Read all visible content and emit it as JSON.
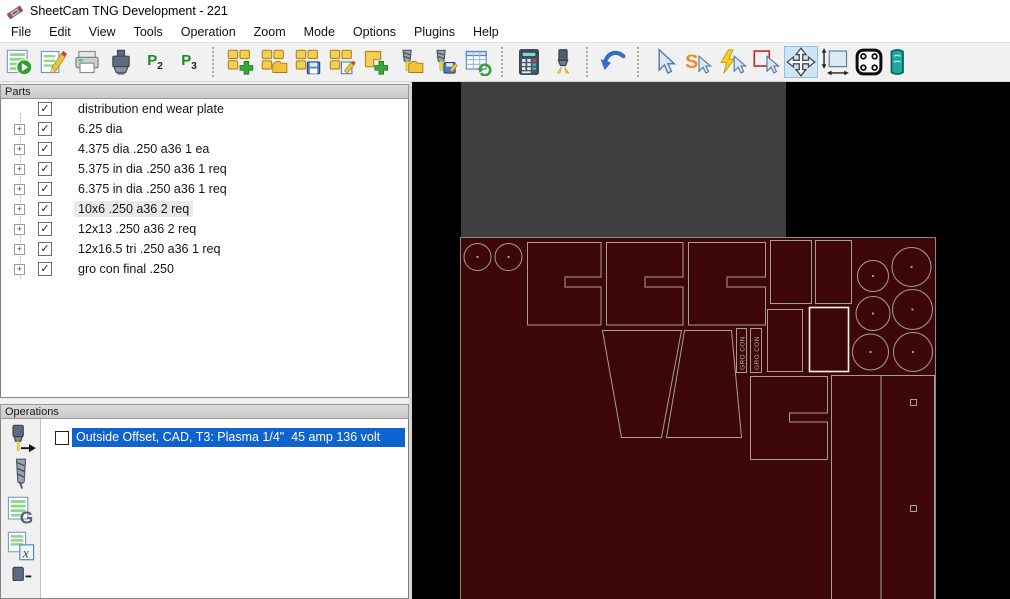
{
  "window": {
    "title": "SheetCam TNG Development - 221"
  },
  "menu": {
    "items": [
      "File",
      "Edit",
      "View",
      "Tools",
      "Operation",
      "Zoom",
      "Mode",
      "Options",
      "Plugins",
      "Help"
    ]
  },
  "toolbar": {
    "p2": {
      "letter": "P",
      "sub": "2"
    },
    "p3": {
      "letter": "P",
      "sub": "3"
    },
    "icon_names": [
      "run-postprocess",
      "edit-postprocess",
      "print",
      "machine-connection",
      "post2",
      "post3",
      "new-job",
      "open-job",
      "save-job",
      "edit-job",
      "add-part",
      "open-toolset",
      "save-toolset",
      "refresh-table",
      "calculator",
      "simulate-torch",
      "undo",
      "select-cursor",
      "select-contour",
      "select-rapid",
      "select-rectangle",
      "move-parts",
      "measure",
      "edit-plate",
      "clipped-right"
    ]
  },
  "icons": {
    "checkmark": "✓",
    "expander_plus": "+"
  },
  "parts_panel": {
    "title": "Parts",
    "items": [
      {
        "label": "distribution end wear plate",
        "expandable": false,
        "checked": true,
        "highlighted": false
      },
      {
        "label": "6.25 dia",
        "expandable": true,
        "checked": true,
        "highlighted": false
      },
      {
        "label": "4.375 dia .250 a36 1 ea",
        "expandable": true,
        "checked": true,
        "highlighted": false
      },
      {
        "label": "5.375 in dia .250 a36 1 req",
        "expandable": true,
        "checked": true,
        "highlighted": false
      },
      {
        "label": "6.375 in dia .250 a36 1 req",
        "expandable": true,
        "checked": true,
        "highlighted": false
      },
      {
        "label": "10x6 .250 a36 2 req",
        "expandable": true,
        "checked": true,
        "highlighted": true
      },
      {
        "label": "12x13 .250 a36 2 req",
        "expandable": true,
        "checked": true,
        "highlighted": false
      },
      {
        "label": "12x16.5 tri .250 a36 1 req",
        "expandable": true,
        "checked": true,
        "highlighted": false
      },
      {
        "label": "gro con final .250",
        "expandable": true,
        "checked": true,
        "highlighted": false
      }
    ]
  },
  "operations_panel": {
    "title": "Operations",
    "items": [
      {
        "label": "Outside Offset, CAD, T3: Plasma 1/4\"  45 amp 136 volt",
        "checked": false,
        "selected": true
      }
    ]
  },
  "canvas": {
    "part_labels": {
      "gro_con_1": "GRO CON",
      "gro_con_2": "GRO CON"
    }
  },
  "colors": {
    "selection_blue": "#0f63cf",
    "sheet_maroon": "#3d0707",
    "table_gray": "#3f3f3f",
    "part_outline": "#a59c9c",
    "selected_part_outline": "#f8f2f2",
    "canvas_background": "#000000"
  }
}
